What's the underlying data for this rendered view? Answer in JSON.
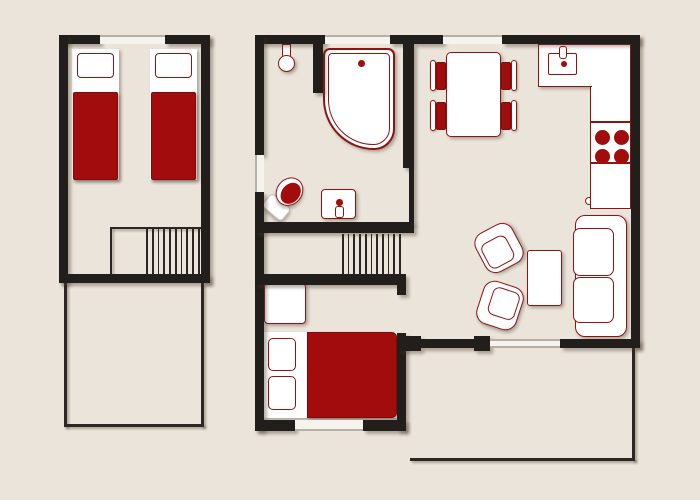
{
  "palette": {
    "bg": "#EAE4DA",
    "wall": "#211E1B",
    "thin": "#2A2623",
    "white": "#FFFFFF",
    "red": "#A30C0C",
    "redline": "#8E1414",
    "reddark": "#7E0A0A",
    "winband": "#F6F3EE",
    "winline": "#B5AFA5",
    "shadow": "rgba(70,55,40,0.38)"
  },
  "plan": {
    "walls": [
      [
        "wall-left-building-top-west",
        59,
        35,
        41,
        9
      ],
      [
        "wall-left-building-top-east",
        165,
        35,
        45,
        9
      ],
      [
        "wall-left-building-west",
        59,
        35,
        9,
        248
      ],
      [
        "wall-left-building-east",
        201,
        35,
        9,
        248
      ],
      [
        "wall-left-building-south",
        59,
        274,
        151,
        9
      ],
      [
        "wall-main-top-1",
        255,
        35,
        70,
        9
      ],
      [
        "wall-main-top-2",
        390,
        35,
        53,
        9
      ],
      [
        "wall-main-top-3",
        502,
        35,
        138,
        9
      ],
      [
        "wall-main-west-upper",
        255,
        35,
        9,
        120
      ],
      [
        "wall-main-west-lower",
        255,
        192,
        9,
        239
      ],
      [
        "wall-main-east",
        631,
        35,
        9,
        313
      ],
      [
        "wall-bath-kitchen-divider",
        403,
        44,
        11,
        124
      ],
      [
        "wall-bath-kitchen-thin",
        409,
        168,
        5,
        56
      ],
      [
        "wall-shower-stub",
        313,
        44,
        10,
        49
      ],
      [
        "wall-bath-south",
        255,
        222,
        159,
        11
      ],
      [
        "wall-stairs-south",
        255,
        274,
        151,
        11
      ],
      [
        "wall-bedroom-east-stub",
        397,
        285,
        9,
        10
      ],
      [
        "wall-bedroom-east",
        397,
        333,
        9,
        98
      ],
      [
        "wall-bedroom-south-west",
        255,
        420,
        40,
        11
      ],
      [
        "wall-bedroom-south-east",
        363,
        420,
        43,
        11
      ],
      [
        "wall-living-south-nub-west",
        397,
        336,
        24,
        15
      ],
      [
        "wall-living-south-door",
        420,
        339,
        55,
        9
      ],
      [
        "wall-living-south-nub-east",
        474,
        336,
        16,
        15
      ],
      [
        "wall-living-south-east",
        560,
        339,
        80,
        9
      ]
    ],
    "windows": [
      [
        "window-left-building-top",
        100,
        35,
        65,
        9,
        "top"
      ],
      [
        "window-bathroom-top",
        325,
        35,
        65,
        9,
        "top"
      ],
      [
        "window-kitchen-top",
        443,
        35,
        59,
        9,
        "top"
      ],
      [
        "window-bathroom-west",
        255,
        155,
        9,
        37,
        "left"
      ],
      [
        "window-bedroom-south",
        295,
        420,
        68,
        11,
        "bottom"
      ],
      [
        "window-living-south",
        490,
        339,
        70,
        9,
        "both"
      ]
    ],
    "thin_lines": [
      [
        "balcony-west-line",
        64,
        283,
        3,
        144
      ],
      [
        "balcony-south-line",
        64,
        424,
        140,
        3
      ],
      [
        "balcony-east-line",
        201,
        283,
        3,
        144
      ],
      [
        "terrace-east-line",
        632,
        348,
        3,
        113
      ],
      [
        "terrace-south-line",
        410,
        458,
        225,
        3
      ],
      [
        "stairs-upper-outline-west",
        110,
        227,
        2,
        47
      ],
      [
        "stairs-upper-outline-north",
        110,
        227,
        91,
        2
      ]
    ],
    "stairs": [
      [
        "stairs-upper-steps",
        146,
        228,
        52,
        46,
        10
      ],
      [
        "stairs-main-steps",
        342,
        234,
        57,
        40,
        11
      ]
    ]
  },
  "rooms": [
    {
      "name": "upper-twin-bedroom",
      "furniture": [
        "twin-bed",
        "twin-bed",
        "staircase"
      ]
    },
    {
      "name": "balcony",
      "furniture": []
    },
    {
      "name": "bathroom",
      "furniture": [
        "shower",
        "corner-bathtub",
        "toilet",
        "washbasin"
      ]
    },
    {
      "name": "kitchen-dining",
      "furniture": [
        "dining-table",
        "chair",
        "chair",
        "chair",
        "chair",
        "l-counter",
        "kitchen-sink",
        "stove",
        "base-cabinet"
      ]
    },
    {
      "name": "hallway",
      "furniture": [
        "staircase"
      ]
    },
    {
      "name": "lower-bedroom",
      "furniture": [
        "double-bed",
        "wardrobe"
      ]
    },
    {
      "name": "living-room",
      "furniture": [
        "sofa",
        "coffee-table",
        "armchair",
        "armchair"
      ]
    },
    {
      "name": "terrace",
      "furniture": []
    }
  ],
  "counts": {
    "stove_burners": 4,
    "sofa_cushions": 2,
    "double_bed_pillows": 2,
    "twin_beds": 2,
    "dining_chairs": 4
  }
}
